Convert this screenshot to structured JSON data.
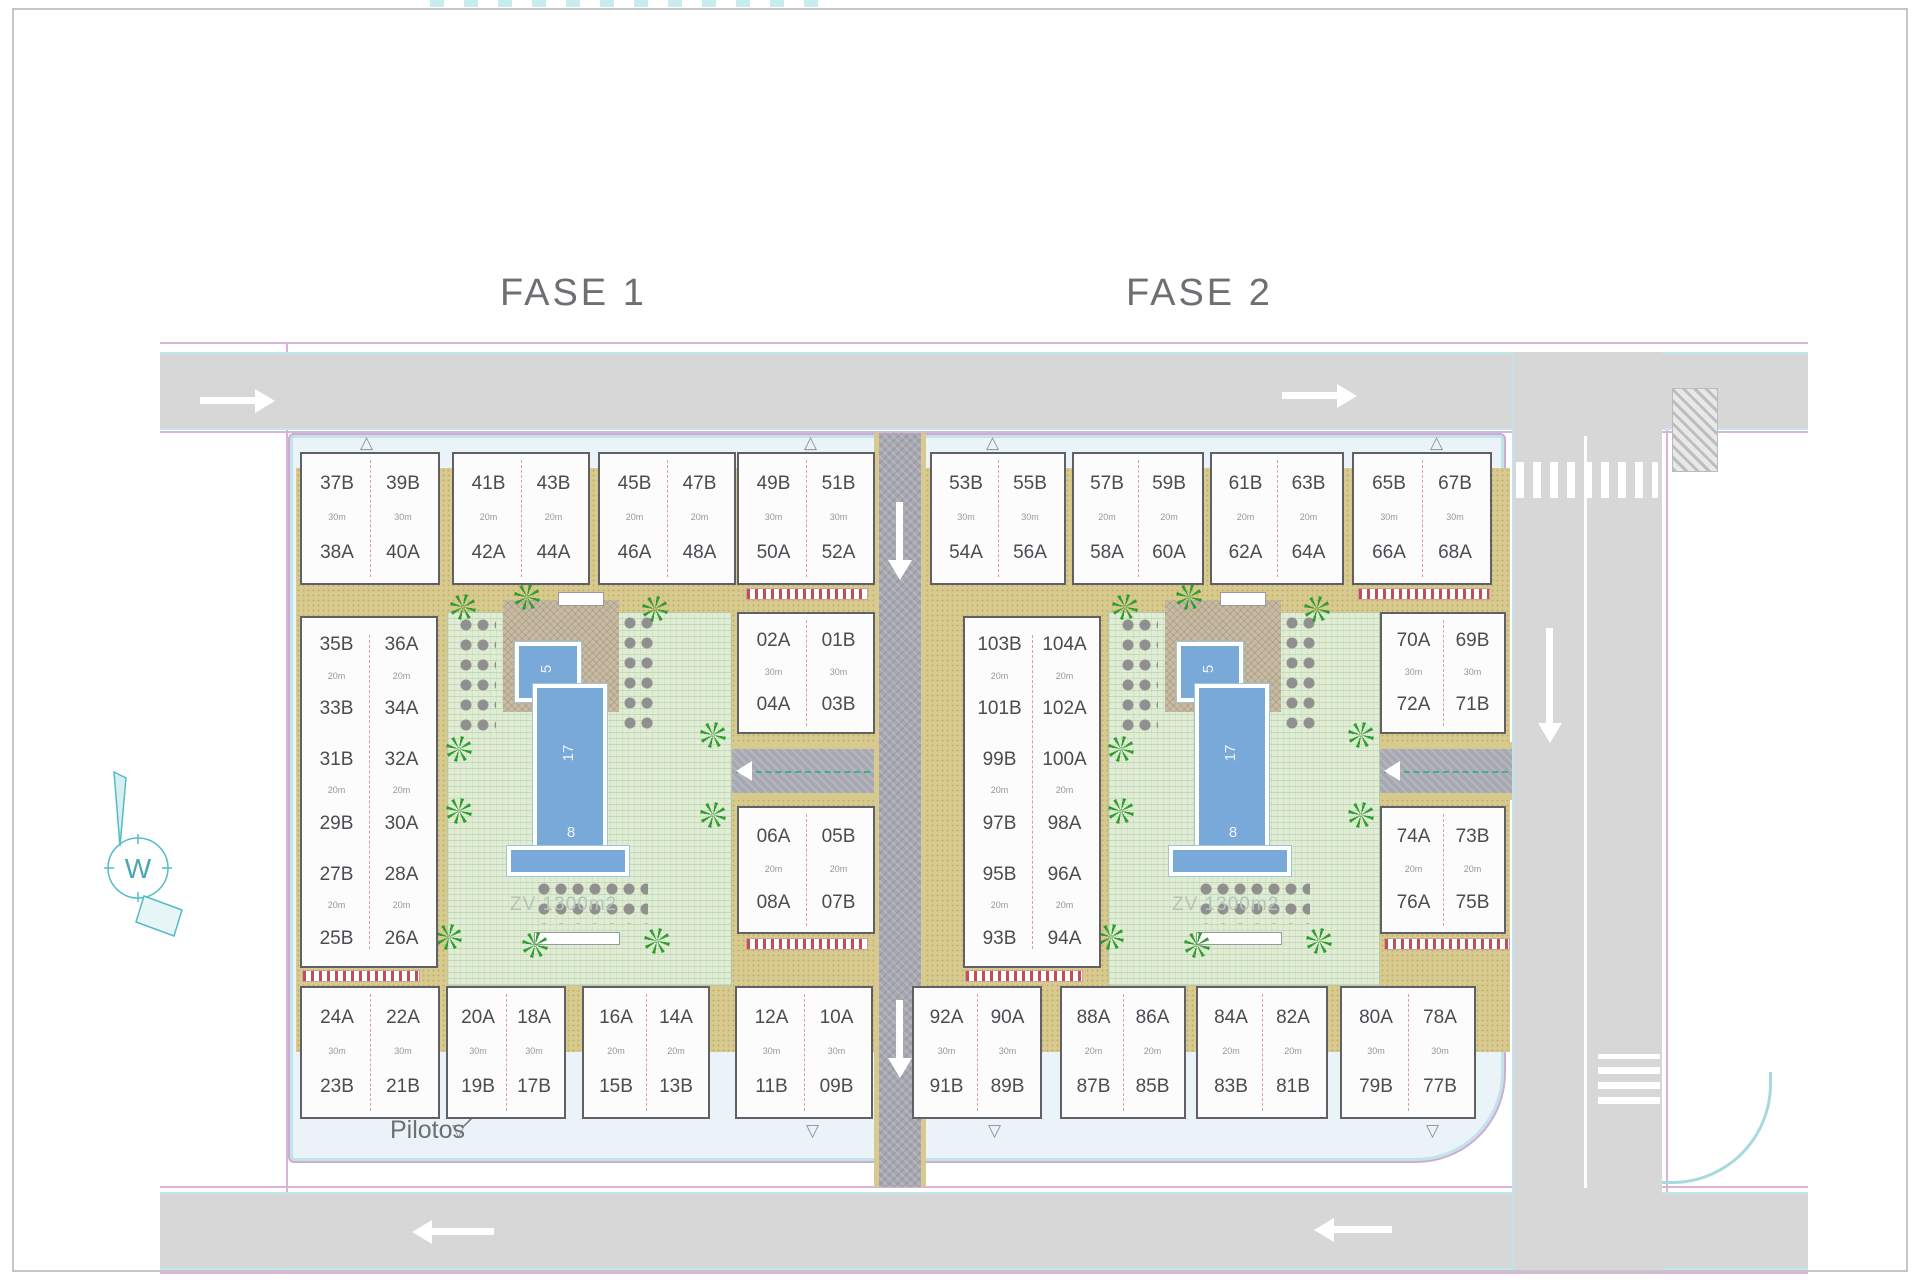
{
  "titles": {
    "fase1": "FASE 1",
    "fase2": "FASE 2"
  },
  "annotations": {
    "pilotos": "Pilotos",
    "green_area_label": "ZV 1300m2"
  },
  "compass": {
    "letter": "W"
  },
  "pool_dims": {
    "length": "17",
    "width": "8",
    "small": "5"
  },
  "icons": {
    "palm_tree": "starburst-css-shape",
    "door_marker_up": "△",
    "door_marker_down": "▽"
  },
  "phase1": {
    "title": "FASE 1",
    "top_blocks": [
      {
        "rows": [
          [
            "37B",
            "39B"
          ],
          [
            "38A",
            "40A"
          ]
        ],
        "area": "30m"
      },
      {
        "rows": [
          [
            "41B",
            "43B"
          ],
          [
            "42A",
            "44A"
          ]
        ],
        "area": "20m"
      },
      {
        "rows": [
          [
            "45B",
            "47B"
          ],
          [
            "46A",
            "48A"
          ]
        ],
        "area": "20m"
      },
      {
        "rows": [
          [
            "49B",
            "51B"
          ],
          [
            "50A",
            "52A"
          ]
        ],
        "area": "30m"
      }
    ],
    "left_column": {
      "rows": [
        [
          "35B",
          "36A"
        ],
        [
          "33B",
          "34A"
        ],
        [
          "31B",
          "32A"
        ],
        [
          "29B",
          "30A"
        ],
        [
          "27B",
          "28A"
        ],
        [
          "25B",
          "26A"
        ]
      ],
      "area": "20m"
    },
    "center_blocks": [
      {
        "rows": [
          [
            "02A",
            "01B"
          ],
          [
            "04A",
            "03B"
          ]
        ],
        "area": "30m"
      },
      {
        "rows": [
          [
            "06A",
            "05B"
          ],
          [
            "08A",
            "07B"
          ]
        ],
        "area": "20m"
      }
    ],
    "bottom_blocks": [
      {
        "rows": [
          [
            "24A",
            "22A"
          ],
          [
            "23B",
            "21B"
          ]
        ],
        "area": "30m"
      },
      {
        "rows": [
          [
            "20A",
            "18A"
          ],
          [
            "19B",
            "17B"
          ]
        ],
        "area": "30m"
      },
      {
        "rows": [
          [
            "16A",
            "14A"
          ],
          [
            "15B",
            "13B"
          ]
        ],
        "area": "20m"
      },
      {
        "rows": [
          [
            "12A",
            "10A"
          ],
          [
            "11B",
            "09B"
          ]
        ],
        "area": "30m"
      }
    ]
  },
  "phase2": {
    "title": "FASE 2",
    "top_blocks": [
      {
        "rows": [
          [
            "53B",
            "55B"
          ],
          [
            "54A",
            "56A"
          ]
        ],
        "area": "30m"
      },
      {
        "rows": [
          [
            "57B",
            "59B"
          ],
          [
            "58A",
            "60A"
          ]
        ],
        "area": "20m"
      },
      {
        "rows": [
          [
            "61B",
            "63B"
          ],
          [
            "62A",
            "64A"
          ]
        ],
        "area": "20m"
      },
      {
        "rows": [
          [
            "65B",
            "67B"
          ],
          [
            "66A",
            "68A"
          ]
        ],
        "area": "30m"
      }
    ],
    "left_column": {
      "rows": [
        [
          "103B",
          "104A"
        ],
        [
          "101B",
          "102A"
        ],
        [
          "99B",
          "100A"
        ],
        [
          "97B",
          "98A"
        ],
        [
          "95B",
          "96A"
        ],
        [
          "93B",
          "94A"
        ]
      ],
      "area": "20m"
    },
    "center_blocks": [
      {
        "rows": [
          [
            "70A",
            "69B"
          ],
          [
            "72A",
            "71B"
          ]
        ],
        "area": "30m"
      },
      {
        "rows": [
          [
            "74A",
            "73B"
          ],
          [
            "76A",
            "75B"
          ]
        ],
        "area": "20m"
      }
    ],
    "bottom_blocks": [
      {
        "rows": [
          [
            "92A",
            "90A"
          ],
          [
            "91B",
            "89B"
          ]
        ],
        "area": "30m"
      },
      {
        "rows": [
          [
            "88A",
            "86A"
          ],
          [
            "87B",
            "85B"
          ]
        ],
        "area": "20m"
      },
      {
        "rows": [
          [
            "84A",
            "82A"
          ],
          [
            "83B",
            "81B"
          ]
        ],
        "area": "20m"
      },
      {
        "rows": [
          [
            "80A",
            "78A"
          ],
          [
            "79B",
            "77B"
          ]
        ],
        "area": "30m"
      }
    ]
  }
}
